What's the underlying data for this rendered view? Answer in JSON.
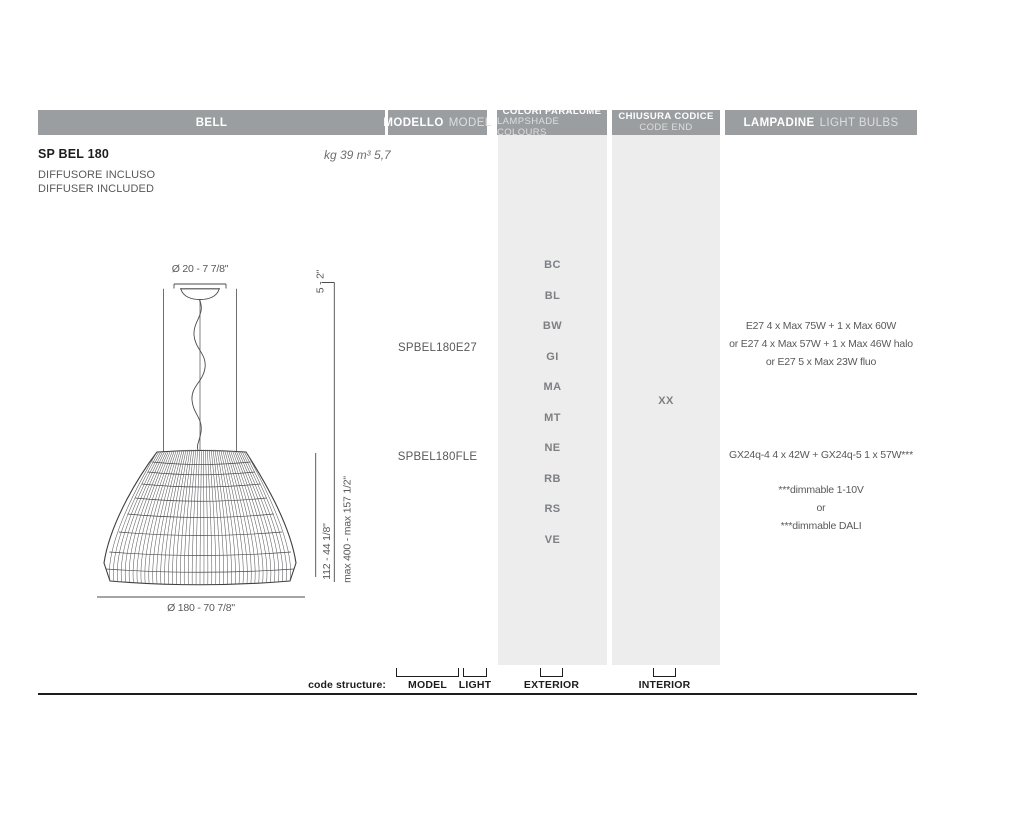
{
  "header": {
    "bell": "BELL",
    "modello_bold": "MODELLO",
    "modello_light": "MODEL",
    "colori_bold": "COLORI PARALUME",
    "colori_light": "LAMPSHADE COLOURS",
    "chiusura_bold": "CHIUSURA CODICE",
    "chiusura_light": "CODE END",
    "lampadine_bold": "LAMPADINE",
    "lampadine_light": "LIGHT BULBS"
  },
  "product": {
    "name": "SP BEL 180",
    "weight_volume": "kg 39 m³ 5,7",
    "note_line1": "DIFFUSORE INCLUSO",
    "note_line2": "DIFFUSER INCLUDED"
  },
  "drawing": {
    "canopy_diameter": "Ø 20 - 7 7/8\"",
    "canopy_height": "5 - 2\"",
    "shade_height": "112 - 44 1/8\"",
    "max_height": "max 400 - max 157 1/2\"",
    "diameter": "Ø 180 - 70 7/8\""
  },
  "models": {
    "e27": "SPBEL180E27",
    "fle": "SPBEL180FLE"
  },
  "lampshade_colours": [
    "BC",
    "BL",
    "BW",
    "GI",
    "MA",
    "MT",
    "NE",
    "RB",
    "RS",
    "VE"
  ],
  "code_end": "XX",
  "bulbs": {
    "e27_line1": "E27 4 x Max 75W + 1 x Max 60W",
    "e27_line2": "or E27 4 x Max 57W + 1 x Max 46W halo",
    "e27_line3": "or E27 5 x Max 23W fluo",
    "fle_line1": "GX24q-4 4 x 42W + GX24q-5 1 x 57W***",
    "note_line1": "***dimmable 1-10V",
    "note_line2": "or",
    "note_line3": "***dimmable DALI"
  },
  "code_structure": {
    "label": "code structure:",
    "model": "MODEL",
    "light": "LIGHT",
    "exterior": "EXTERIOR",
    "interior": "INTERIOR"
  },
  "palette": {
    "header_bg": "#9b9ea1",
    "column_bg": "#ededee",
    "text_dark": "#1d1d1f",
    "text_gray": "#58595b",
    "drawing_line": "#4b4b4d"
  }
}
